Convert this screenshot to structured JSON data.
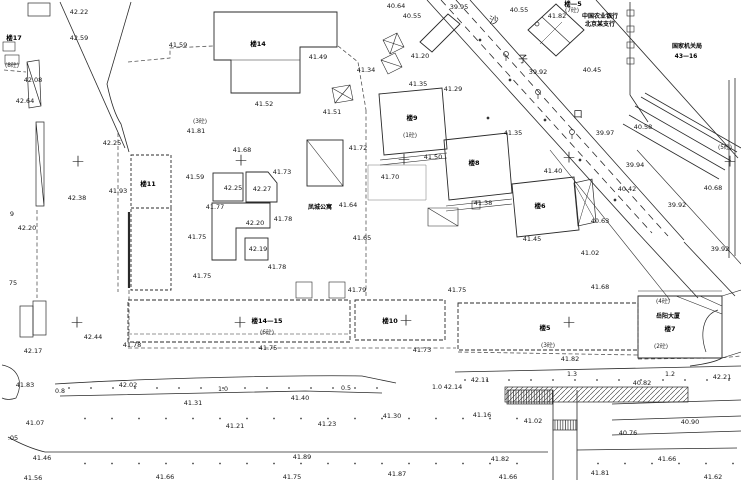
{
  "map": {
    "colors": {
      "line": "#2a2a2a",
      "fence": "#555555",
      "background": "#ffffff",
      "text": "#161616"
    },
    "elevation_labels": [
      {
        "x": 79,
        "y": 12,
        "v": "42.22"
      },
      {
        "x": 79,
        "y": 38,
        "v": "42.59"
      },
      {
        "x": 178,
        "y": 45,
        "v": "41.59"
      },
      {
        "x": 33,
        "y": 80,
        "v": "42.08"
      },
      {
        "x": 25,
        "y": 101,
        "v": "42.64"
      },
      {
        "x": 196,
        "y": 131,
        "v": "41.81"
      },
      {
        "x": 112,
        "y": 143,
        "v": "42.25"
      },
      {
        "x": 318,
        "y": 57,
        "v": "41.49"
      },
      {
        "x": 264,
        "y": 104,
        "v": "41.52"
      },
      {
        "x": 332,
        "y": 112,
        "v": "41.51"
      },
      {
        "x": 396,
        "y": 6,
        "v": "40.64"
      },
      {
        "x": 412,
        "y": 16,
        "v": "40.55"
      },
      {
        "x": 459,
        "y": 7,
        "v": "39.95"
      },
      {
        "x": 519,
        "y": 10,
        "v": "40.55"
      },
      {
        "x": 557,
        "y": 16,
        "v": "41.82"
      },
      {
        "x": 366,
        "y": 70,
        "v": "41.34"
      },
      {
        "x": 420,
        "y": 56,
        "v": "41.20"
      },
      {
        "x": 418,
        "y": 84,
        "v": "41.35"
      },
      {
        "x": 453,
        "y": 89,
        "v": "41.29"
      },
      {
        "x": 358,
        "y": 148,
        "v": "41.72"
      },
      {
        "x": 433,
        "y": 157,
        "v": "41.50"
      },
      {
        "x": 390,
        "y": 177,
        "v": "41.70"
      },
      {
        "x": 513,
        "y": 133,
        "v": "41.35"
      },
      {
        "x": 553,
        "y": 171,
        "v": "41.40"
      },
      {
        "x": 483,
        "y": 203,
        "v": "41.38"
      },
      {
        "x": 592,
        "y": 70,
        "v": "40.45"
      },
      {
        "x": 538,
        "y": 72,
        "v": "39.92"
      },
      {
        "x": 643,
        "y": 127,
        "v": "40.58"
      },
      {
        "x": 605,
        "y": 133,
        "v": "39.97"
      },
      {
        "x": 635,
        "y": 165,
        "v": "39.94"
      },
      {
        "x": 627,
        "y": 189,
        "v": "40.42"
      },
      {
        "x": 677,
        "y": 205,
        "v": "39.92"
      },
      {
        "x": 713,
        "y": 188,
        "v": "40.68"
      },
      {
        "x": 600,
        "y": 221,
        "v": "40.63"
      },
      {
        "x": 532,
        "y": 239,
        "v": "41.45"
      },
      {
        "x": 590,
        "y": 253,
        "v": "41.02"
      },
      {
        "x": 720,
        "y": 249,
        "v": "39.92"
      },
      {
        "x": 600,
        "y": 287,
        "v": "41.68"
      },
      {
        "x": 118,
        "y": 191,
        "v": "41.93"
      },
      {
        "x": 77,
        "y": 198,
        "v": "42.38"
      },
      {
        "x": 27,
        "y": 228,
        "v": "42.20"
      },
      {
        "x": 195,
        "y": 177,
        "v": "41.59"
      },
      {
        "x": 215,
        "y": 207,
        "v": "41.77"
      },
      {
        "x": 197,
        "y": 237,
        "v": "41.75"
      },
      {
        "x": 202,
        "y": 276,
        "v": "41.75"
      },
      {
        "x": 242,
        "y": 150,
        "v": "41.68"
      },
      {
        "x": 282,
        "y": 172,
        "v": "41.73"
      },
      {
        "x": 233,
        "y": 188,
        "v": "42.25"
      },
      {
        "x": 262,
        "y": 189,
        "v": "42.27"
      },
      {
        "x": 255,
        "y": 223,
        "v": "42.20"
      },
      {
        "x": 283,
        "y": 219,
        "v": "41.78"
      },
      {
        "x": 258,
        "y": 249,
        "v": "42.19"
      },
      {
        "x": 277,
        "y": 267,
        "v": "41.78"
      },
      {
        "x": 348,
        "y": 205,
        "v": "41.64"
      },
      {
        "x": 362,
        "y": 238,
        "v": "41.65"
      },
      {
        "x": 357,
        "y": 290,
        "v": "41.79"
      },
      {
        "x": 457,
        "y": 290,
        "v": "41.75"
      },
      {
        "x": 268,
        "y": 348,
        "v": "41.75"
      },
      {
        "x": 422,
        "y": 350,
        "v": "41.73"
      },
      {
        "x": 453,
        "y": 387,
        "v": "42.14"
      },
      {
        "x": 480,
        "y": 380,
        "v": "42.11"
      },
      {
        "x": 300,
        "y": 398,
        "v": "41.40"
      },
      {
        "x": 392,
        "y": 416,
        "v": "41.30"
      },
      {
        "x": 482,
        "y": 415,
        "v": "41.16"
      },
      {
        "x": 327,
        "y": 424,
        "v": "41.23"
      },
      {
        "x": 302,
        "y": 457,
        "v": "41.89"
      },
      {
        "x": 292,
        "y": 477,
        "v": "41.75"
      },
      {
        "x": 397,
        "y": 474,
        "v": "41.87"
      },
      {
        "x": 93,
        "y": 337,
        "v": "42.44"
      },
      {
        "x": 33,
        "y": 351,
        "v": "42.17"
      },
      {
        "x": 132,
        "y": 345,
        "v": "41.78"
      },
      {
        "x": 25,
        "y": 385,
        "v": "41.83"
      },
      {
        "x": 128,
        "y": 385,
        "v": "42.02"
      },
      {
        "x": 193,
        "y": 403,
        "v": "41.31"
      },
      {
        "x": 35,
        "y": 423,
        "v": "41.07"
      },
      {
        "x": 235,
        "y": 426,
        "v": "41.21"
      },
      {
        "x": 42,
        "y": 458,
        "v": "41.46"
      },
      {
        "x": 33,
        "y": 478,
        "v": "41.56"
      },
      {
        "x": 165,
        "y": 477,
        "v": "41.66"
      },
      {
        "x": 533,
        "y": 421,
        "v": "41.02"
      },
      {
        "x": 690,
        "y": 422,
        "v": "40.90"
      },
      {
        "x": 628,
        "y": 433,
        "v": "40.76"
      },
      {
        "x": 500,
        "y": 459,
        "v": "41.82"
      },
      {
        "x": 667,
        "y": 459,
        "v": "41.66"
      },
      {
        "x": 508,
        "y": 477,
        "v": "41.66"
      },
      {
        "x": 600,
        "y": 473,
        "v": "41.81"
      },
      {
        "x": 713,
        "y": 477,
        "v": "41.62"
      },
      {
        "x": 570,
        "y": 359,
        "v": "41.82"
      },
      {
        "x": 722,
        "y": 377,
        "v": "42.21"
      },
      {
        "x": 642,
        "y": 383,
        "v": "40.82"
      },
      {
        "x": 12,
        "y": 214,
        "v": "9"
      },
      {
        "x": 13,
        "y": 283,
        "v": "75"
      },
      {
        "x": 13,
        "y": 438,
        "v": ".05"
      }
    ],
    "building_labels": [
      {
        "x": 14,
        "y": 38,
        "v": "楼17"
      },
      {
        "x": 258,
        "y": 44,
        "v": "楼14"
      },
      {
        "x": 148,
        "y": 184,
        "v": "楼11"
      },
      {
        "x": 412,
        "y": 118,
        "v": "楼9"
      },
      {
        "x": 474,
        "y": 163,
        "v": "楼8"
      },
      {
        "x": 540,
        "y": 206,
        "v": "楼6"
      },
      {
        "x": 267,
        "y": 321,
        "v": "楼14—15"
      },
      {
        "x": 390,
        "y": 321,
        "v": "楼10"
      },
      {
        "x": 545,
        "y": 328,
        "v": "楼5"
      },
      {
        "x": 670,
        "y": 329,
        "v": "楼7"
      },
      {
        "x": 573,
        "y": 4,
        "v": "楼—5"
      }
    ],
    "floor_annotations": [
      {
        "x": 200,
        "y": 123,
        "v": "(3砼)"
      },
      {
        "x": 410,
        "y": 137,
        "v": "(1砼)"
      },
      {
        "x": 572,
        "y": 12,
        "v": "(7砼)"
      },
      {
        "x": 267,
        "y": 334,
        "v": "(6砼)"
      },
      {
        "x": 548,
        "y": 347,
        "v": "(3砼)"
      },
      {
        "x": 661,
        "y": 348,
        "v": "(2砼)"
      },
      {
        "x": 725,
        "y": 149,
        "v": "(5砼)"
      },
      {
        "x": 663,
        "y": 303,
        "v": "(4砼)"
      },
      {
        "x": 12,
        "y": 67,
        "v": "(8砼)"
      }
    ],
    "distance_labels": [
      {
        "x": 60,
        "y": 392,
        "v": "0.8"
      },
      {
        "x": 223,
        "y": 390,
        "v": "1.0"
      },
      {
        "x": 346,
        "y": 389,
        "v": "0.5"
      },
      {
        "x": 437,
        "y": 388,
        "v": "1.0"
      },
      {
        "x": 572,
        "y": 375,
        "v": "1.3"
      },
      {
        "x": 670,
        "y": 375,
        "v": "1.2"
      }
    ],
    "name_labels": [
      {
        "x": 600,
        "y": 17,
        "v": "中国农业银行"
      },
      {
        "x": 600,
        "y": 25,
        "v": "北京某支行"
      },
      {
        "x": 687,
        "y": 47,
        "v": "国家机关局"
      },
      {
        "x": 686,
        "y": 57,
        "v": "43—16"
      },
      {
        "x": 320,
        "y": 208,
        "v": "凤城公寓"
      },
      {
        "x": 668,
        "y": 317,
        "v": "岳阳大厦"
      }
    ],
    "street_name_chars": [
      {
        "x": 494,
        "y": 21,
        "v": "沙"
      },
      {
        "x": 523,
        "y": 60,
        "v": "子"
      },
      {
        "x": 578,
        "y": 115,
        "v": "口"
      }
    ],
    "survey_crosses": [
      {
        "x": 78,
        "y": 162,
        "v": "+"
      },
      {
        "x": 241,
        "y": 161,
        "v": "+"
      },
      {
        "x": 404,
        "y": 160,
        "v": "+"
      },
      {
        "x": 569,
        "y": 158,
        "v": "+"
      },
      {
        "x": 730,
        "y": 162,
        "v": "+"
      },
      {
        "x": 77,
        "y": 323,
        "v": "+"
      },
      {
        "x": 240,
        "y": 323,
        "v": "+"
      },
      {
        "x": 406,
        "y": 321,
        "v": "+"
      },
      {
        "x": 569,
        "y": 323,
        "v": "+"
      }
    ]
  }
}
